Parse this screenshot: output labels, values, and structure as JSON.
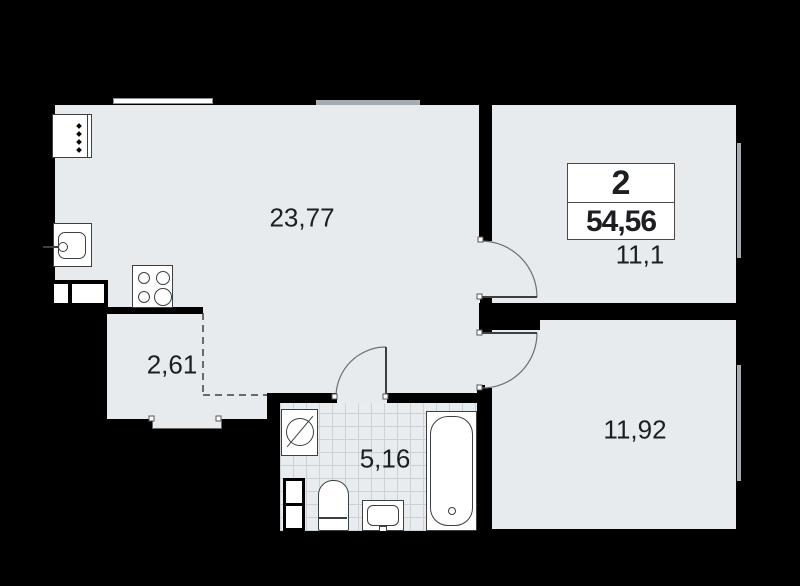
{
  "floor_plan": {
    "summary": {
      "rooms_count": "2",
      "total_area": "54,56"
    },
    "rooms": [
      {
        "name": "kitchen-living-room",
        "area": "23,77"
      },
      {
        "name": "bedroom",
        "area": "11,1"
      },
      {
        "name": "bedroom-2",
        "area": "11,92"
      },
      {
        "name": "entry-hall",
        "area": "2,61"
      },
      {
        "name": "bathroom",
        "area": "5,16"
      }
    ],
    "colors": {
      "background": "#000000",
      "floor": "#e8ebee",
      "wall": "#000000",
      "tile_line": "#ccd1d5",
      "fixture_line": "#3c4043",
      "window": "#a7acb1",
      "text": "#1c1e21"
    }
  }
}
